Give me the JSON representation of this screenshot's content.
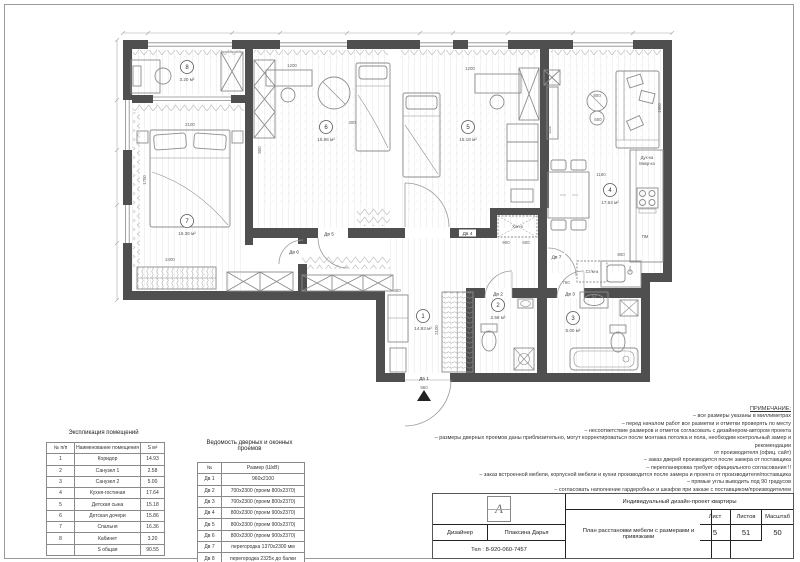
{
  "plan": {
    "rooms": [
      {
        "number": "1",
        "area": "14.93 м²"
      },
      {
        "number": "2",
        "area": "2.58 м²"
      },
      {
        "number": "3",
        "area": "5.00 м²"
      },
      {
        "number": "4",
        "area": "17.64 м²"
      },
      {
        "number": "5",
        "area": "15.18 м²"
      },
      {
        "number": "6",
        "area": "15.86 м²"
      },
      {
        "number": "7",
        "area": "16.36 м²"
      },
      {
        "number": "8",
        "area": "3.20 м²"
      }
    ],
    "doors": [
      "Дв 1",
      "Дв 2",
      "Дв 3",
      "Дв 4",
      "Дв 5",
      "Дв 6",
      "Дв 7"
    ],
    "labels": {
      "fridge": "Хол-к",
      "washer": "Ст/м-а",
      "oven": "Дух-ка",
      "microwave": "Микр-ка",
      "dishwasher": "ПМ"
    },
    "dims": [
      "1200",
      "1200",
      "400",
      "500",
      "2100",
      "1700",
      "2400",
      "2100",
      "400",
      "960",
      "900",
      "600",
      "760",
      "1180",
      "800",
      "650",
      "1900",
      "415",
      "800"
    ]
  },
  "explication": {
    "title": "Экспликация помещений",
    "headers": [
      "№ п/п",
      "Наименование помещения",
      "S м²"
    ],
    "rows": [
      [
        "1",
        "Коридор",
        "14.93"
      ],
      [
        "2",
        "Санузел 1",
        "2.58"
      ],
      [
        "3",
        "Санузел 2",
        "5.00"
      ],
      [
        "4",
        "Кухня-гостиная",
        "17.64"
      ],
      [
        "5",
        "Детская сына",
        "15.18"
      ],
      [
        "6",
        "Детская дочери",
        "15.86"
      ],
      [
        "7",
        "Спальня",
        "16.36"
      ],
      [
        "8",
        "Кабинет",
        "3.20"
      ],
      [
        "",
        "S общая",
        "90.55"
      ]
    ]
  },
  "openings": {
    "title_line1": "Ведомость дверных и оконных",
    "title_line2": "проемов",
    "headers": [
      "№",
      "Размер (ШхВ)"
    ],
    "rows": [
      [
        "Дв 1",
        "960х2100"
      ],
      [
        "Дв 2",
        "700х2300 (проем 800х2370)"
      ],
      [
        "Дв 3",
        "700х2300 (проем 800х2370)"
      ],
      [
        "Дв 4",
        "800х2300 (проем 900х2370)"
      ],
      [
        "Дв 5",
        "800х2300 (проем 900х2370)"
      ],
      [
        "Дв 6",
        "800х2300 (проем 900х2370)"
      ],
      [
        "Дв 7",
        "перегородка 1370х2300 мм"
      ],
      [
        "Дв 8",
        "перегородка 2325х до балки"
      ]
    ]
  },
  "notes": {
    "title": "ПРИМЕЧАНИЕ:",
    "lines": [
      "– все размеры указаны в миллиметрах",
      "– перед началом работ все разметки и отметки проверять по месту",
      "– несоответствие размеров и отметок согласовать с дизайнером-автором проекта",
      "– размеры дверных проемов даны приблизительно, могут корректироваться после монтажа потолка и пола, необходим контрольный замер и рекомендации",
      "от производителя (офиц. сайт)",
      "– заказ дверей производится после замера от поставщика",
      "– перепланировка требует официального согласования !!",
      "– заказ встроенной мебели, корпусной мебели и кухни производится после замера и проекта от производителя/поставщика",
      "– прямые углы выводить под 90 градусов",
      "– согласовать наполнение гардеробных и шкафов при заказе с поставщиком/производителем"
    ]
  },
  "titleblock": {
    "project": "Индивидуальный дизайн-проект квартиры",
    "drawing": "План расстановки мебели с размерами и привязками",
    "sheet_label": "Лист",
    "sheet": "5",
    "sheets_label": "Листов",
    "sheets": "51",
    "scale_label": "Масштаб",
    "scale": "50",
    "designer_label": "Дизайнер",
    "designer": "Плаксина Дарья",
    "phone": "Тел : 8-920-060-7457",
    "logo_letter": "A"
  }
}
